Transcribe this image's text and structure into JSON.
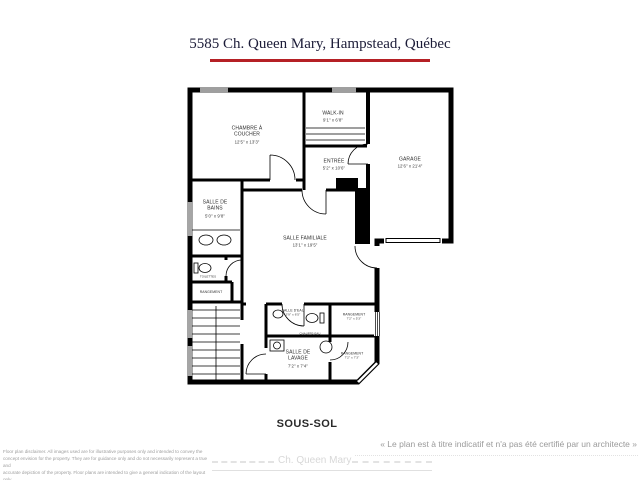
{
  "title": "5585 Ch. Queen Mary, Hampstead, Québec",
  "floor_label": "SOUS-SOL",
  "certification_note": "« Le plan est à titre indicatif et n'a pas été certifié par un architecte »",
  "disclaimer": {
    "lines": [
      "Floor plan disclaimer. All images used are for illustrative purposes only and intended to convey the",
      "concept envision for the property. They are for guidance only and do not necessarily represent a true and",
      "accurate depiction of the property. Floor plans are intended to give a general indication of the layout only.",
      "All images and dimensions are not intended to form any contract or warranty."
    ]
  },
  "watermark": {
    "road_label": "Ch. Queen Mary"
  },
  "colors": {
    "title_text": "#1c1c38",
    "title_underline": "#b52025",
    "walls": "#000000",
    "watermark_gray": "#d8d8d8"
  },
  "rooms": {
    "chambre": {
      "name": "CHAMBRE À COUCHER",
      "dims": "12'5\" x 13'3\""
    },
    "walkin": {
      "name": "WALK-IN",
      "dims": "9'1\" x 6'8\""
    },
    "entree": {
      "name": "ENTRÉE",
      "dims": "5'2\" x 10'6\""
    },
    "garage": {
      "name": "GARAGE",
      "dims": "12'6\" x 21'4\""
    },
    "bains": {
      "name": "SALLE DE BAINS",
      "dims": "5'0\" x 9'8\""
    },
    "toilettes": {
      "name": "TOILETTES"
    },
    "rangement_hall": {
      "name": "RANGEMENT"
    },
    "familiale": {
      "name": "SALLE FAMILIALE",
      "dims": "13'1\" x 19'5\""
    },
    "salle_eau": {
      "name": "SALLE D'EAU",
      "dims": "3'9\" x 6'5\""
    },
    "rangement_mid": {
      "name": "RANGEMENT",
      "dims": "7'2\" x 5'3\""
    },
    "lavage": {
      "name": "SALLE DE LAVAGE",
      "dims": "7'2\" x 7'4\""
    },
    "rangement_br": {
      "name": "RANGEMENT",
      "dims": "7'2\" x 7'3\""
    },
    "chauffe_eau": {
      "name": "CHAUFFE-EAU"
    }
  },
  "fixtures": [
    "double-sink",
    "toilet",
    "toilet",
    "laundry-sink",
    "water-heater",
    "staircase",
    "garage-door"
  ]
}
